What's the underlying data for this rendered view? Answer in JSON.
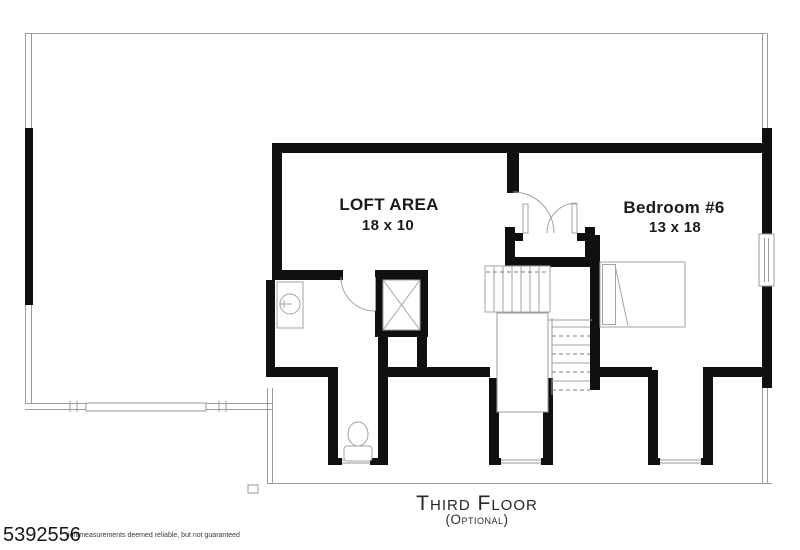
{
  "colors": {
    "background": "#ffffff",
    "wall": "#101010",
    "thin": "#9a9a9a",
    "fixture": "#a3a3a3",
    "dash": "#7d7d7d",
    "text": "#1b1b1b"
  },
  "rooms": {
    "loft": {
      "name": "LOFT AREA",
      "dimensions": "18 x 10"
    },
    "bedroom6": {
      "name": "Bedroom #6",
      "dimensions": "13 x 18"
    }
  },
  "fixtures": [
    "stairs",
    "double-door",
    "bathroom-door",
    "closet",
    "sink",
    "toilet",
    "bed",
    "window",
    "dormer-window"
  ],
  "footer": {
    "floor_title": "Third Floor",
    "floor_subtitle": "(Optional)",
    "listing_number": "5392556",
    "disclaimer": "tion/measurements deemed reliable, but not guaranteed"
  }
}
